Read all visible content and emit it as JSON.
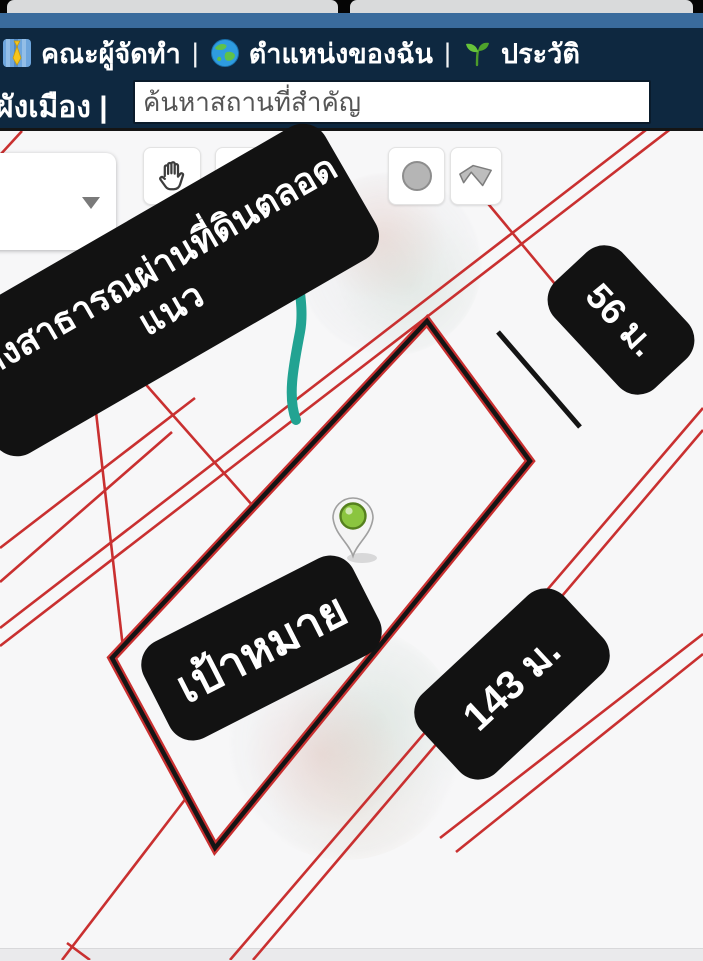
{
  "browser": {
    "tab_count": "2"
  },
  "navbar": {
    "separator": "|",
    "menu": [
      {
        "icon": "necktie-icon",
        "label": "คณะผู้จัดทำ"
      },
      {
        "icon": "globe-icon",
        "label": "ตำแหน่งของฉัน"
      },
      {
        "icon": "seedling-icon",
        "label": "ประวัติ"
      }
    ],
    "layer_label": "ผังเมือง |",
    "search": {
      "placeholder": "ค้นหาสถานที่สำคัญ",
      "value": ""
    }
  },
  "toolbar": {
    "dropdown_value": "ที่",
    "tools": [
      "pan-hand",
      "circle-outline",
      "circle-filled",
      "polygon"
    ]
  },
  "map": {
    "annotations": {
      "note_line1": "ทางสาธารณผ่านที่ดินตลอด",
      "note_line2": "แนว",
      "note_full": "ทางสาธารณผ่านที่ดินตลอดแนว",
      "width_label": "56 ม.",
      "target_label": "เป้าหมาย",
      "length_label": "143 ม."
    },
    "colors": {
      "parcel_outline": "#141414",
      "boundary_red": "#c93030",
      "path_teal": "#22a392",
      "pin_green": "#8bc53f",
      "label_bg": "#121212",
      "label_text": "#ffffff",
      "navbar_bg": "#0e2840"
    }
  }
}
